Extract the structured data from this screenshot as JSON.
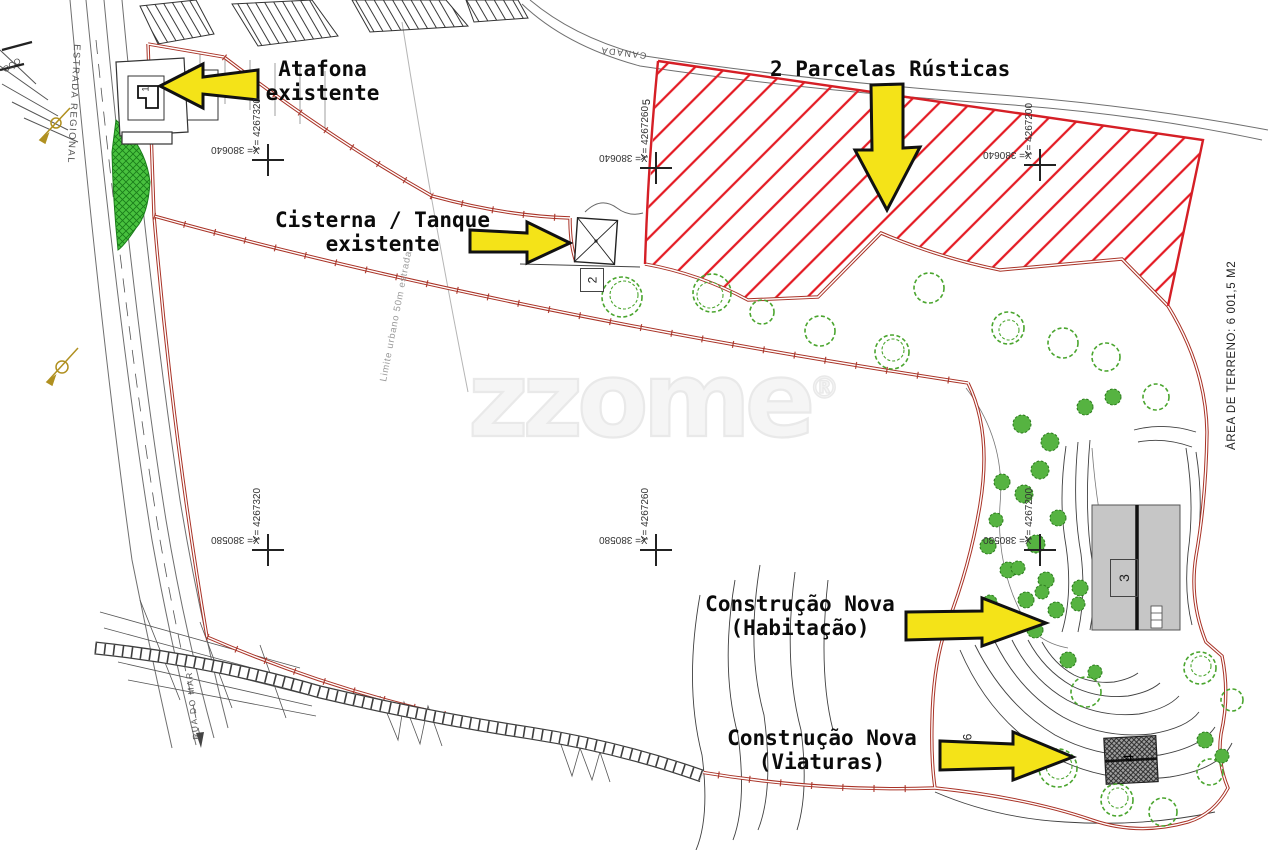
{
  "annotations": {
    "atafona_line1": "Atafona",
    "atafona_line2": "existente",
    "cisterna_line1": "Cisterna / Tanque",
    "cisterna_line2": "existente",
    "parcelas_title": "2 Parcelas Rústicas",
    "habitacao_line1": "Construção Nova",
    "habitacao_line2": "(Habitação)",
    "viaturas_line1": "Construção Nova",
    "viaturas_line2": "(Viaturas)"
  },
  "side_label": "ÁREA DE TERRENO: 6 001,5 M2",
  "watermark_text": "zzome",
  "watermark_reg": "®",
  "road_labels": {
    "estrada_regional": "ESTRADA REGIONAL",
    "rua_do_mar": "RUA DO MAR",
    "canada": "CANADA",
    "limite_urbano": "Limite urbano 50m estrada",
    "poco_partial": "OÇO"
  },
  "coordinate_markers": [
    {
      "y_label": "Y= 4267320",
      "x_label": "X= 380640"
    },
    {
      "y_label": "Y= 4267260",
      "x_label": "X= 380640"
    },
    {
      "y_label": "Y= 4267200",
      "x_label": "X= 380640"
    },
    {
      "y_label": "Y= 4267320",
      "x_label": "X= 380580"
    },
    {
      "y_label": "Y= 4267260",
      "x_label": "X= 380580"
    },
    {
      "y_label": "Y= 4267200",
      "x_label": "X= 380580"
    }
  ],
  "plan_numbers": {
    "n1": "1",
    "n2": "2",
    "n3": "3",
    "n4": "4",
    "n5": "5",
    "n6": "6"
  },
  "colors": {
    "boundary_red": "#a93226",
    "parcel_hatch_red": "#e41b24",
    "arrow_yellow": "#f4e318",
    "arrow_outline": "#111111",
    "tree_green": "#4aa52e",
    "grass_green": "#48c13e",
    "contour_gray": "#404040",
    "building_gray": "#c6c6c6",
    "survey_olive": "#b09020"
  }
}
